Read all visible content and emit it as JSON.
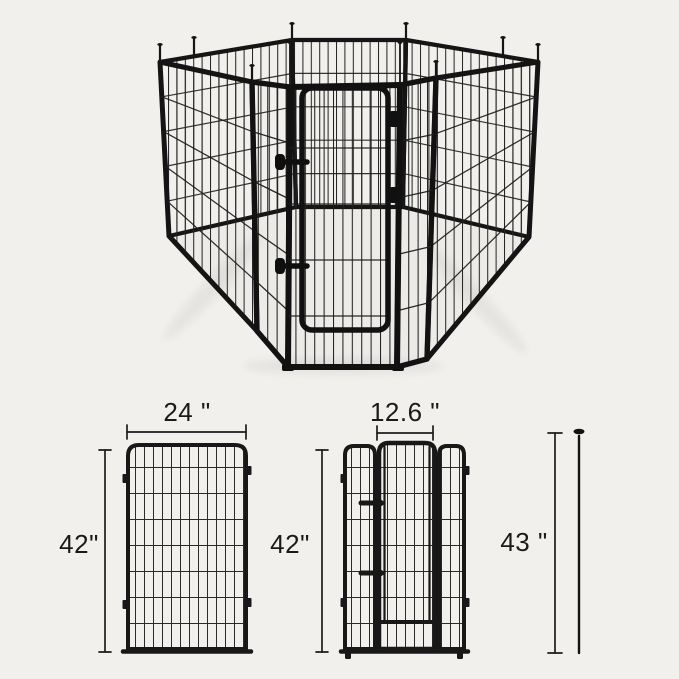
{
  "canvas": {
    "width": 679,
    "height": 679,
    "background": "#f2f0ed"
  },
  "product_photo": {
    "description": "8-panel black metal dog playpen arranged in an octagon, front panel with walk-through gate and slide latches, ground-stake pins at each corner",
    "frame_color": "#151515",
    "wire_color": "#242424"
  },
  "dimension_labels": {
    "panel_width": "24 \"",
    "gate_width": "12.6 \"",
    "panel_height": "42\"",
    "gate_panel_height": "42\"",
    "stake_height": "43 \""
  },
  "ink_color": "#1a1a1a"
}
